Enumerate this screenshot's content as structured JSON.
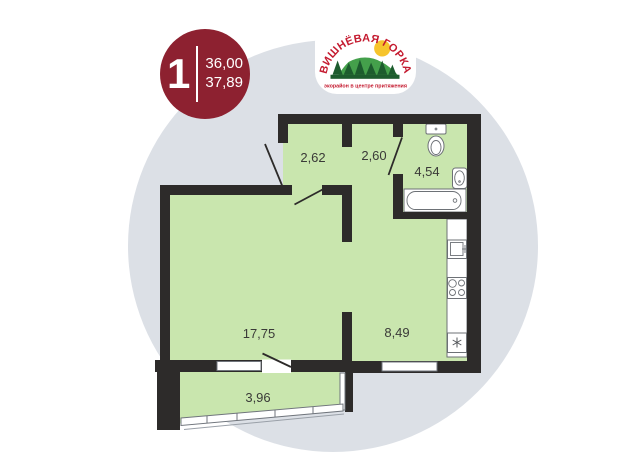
{
  "badge": {
    "rooms": "1",
    "area_living": "36,00",
    "area_total": "37,89"
  },
  "logo": {
    "title": "ВИШНЁВАЯ ГОРКА",
    "tagline": "экорайон в центре притяжения"
  },
  "plan": {
    "type": "apartment-floor-plan",
    "labels": {
      "hall1": "2,62",
      "hall2": "2,60",
      "bath": "4,54",
      "living": "17,75",
      "kitchen": "8,49",
      "balcony": "3,96"
    },
    "fixtures": [
      "toilet",
      "wash-basin",
      "bathtub",
      "kitchen-sink",
      "stove",
      "fridge"
    ],
    "colors": {
      "room_fill": "#c9e6ae",
      "wall": "#2d2b2a",
      "background_circle": "#dce0e6",
      "badge_red": "#8d2130",
      "logo_red": "#c41a2f",
      "logo_green": "#44a04b",
      "logo_dark_green": "#1d5c2e",
      "sun_yellow": "#f6c42c"
    }
  }
}
